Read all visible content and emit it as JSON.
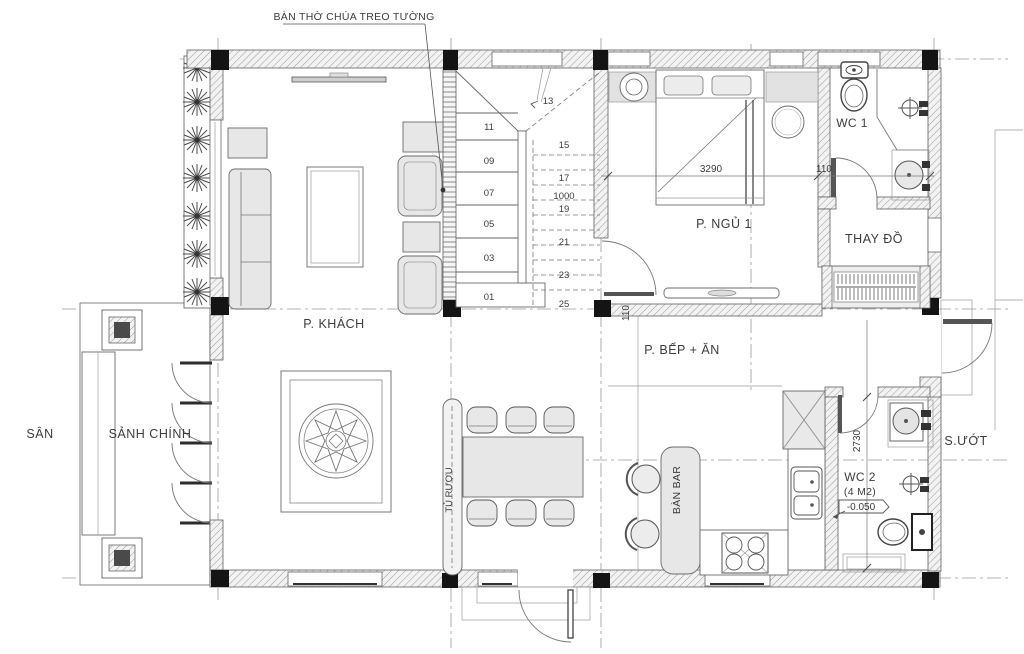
{
  "drawing": {
    "annotation": {
      "altar": "BÀN THỜ CHÚA TREO TƯỜNG"
    },
    "rooms": {
      "living": "P. KHÁCH",
      "bedroom1": "P. NGỦ 1",
      "kitchen_dining": "P. BẾP + ĂN",
      "hall": "SẢNH CHÍNH",
      "yard": "SÂN",
      "wet_area": "S.ƯỚT",
      "dressing": "THAY ĐỒ",
      "wc1": "WC 1",
      "wc2": "WC 2",
      "wc2_area": "(4 M2)",
      "wc2_level": "-0.050"
    },
    "furniture": {
      "bar": "BÀN BAR",
      "wine_cabinet": "TỦ RƯỢU"
    },
    "stairs": {
      "steps": [
        "01",
        "03",
        "05",
        "07",
        "09",
        "11",
        "13",
        "15",
        "17",
        "19",
        "21",
        "23",
        "25"
      ],
      "width_dim": "1000"
    },
    "dimensions": {
      "bed_span": "3290",
      "offset_bedroom": "110",
      "offset_kitchen": "110",
      "wc_span": "2730"
    },
    "colors": {
      "line": "#4a4a4a",
      "wall_hatch": "#9a9a9a",
      "column": "#141414",
      "furniture_fill": "#e7e7e7",
      "text": "#3c3c3c"
    }
  }
}
